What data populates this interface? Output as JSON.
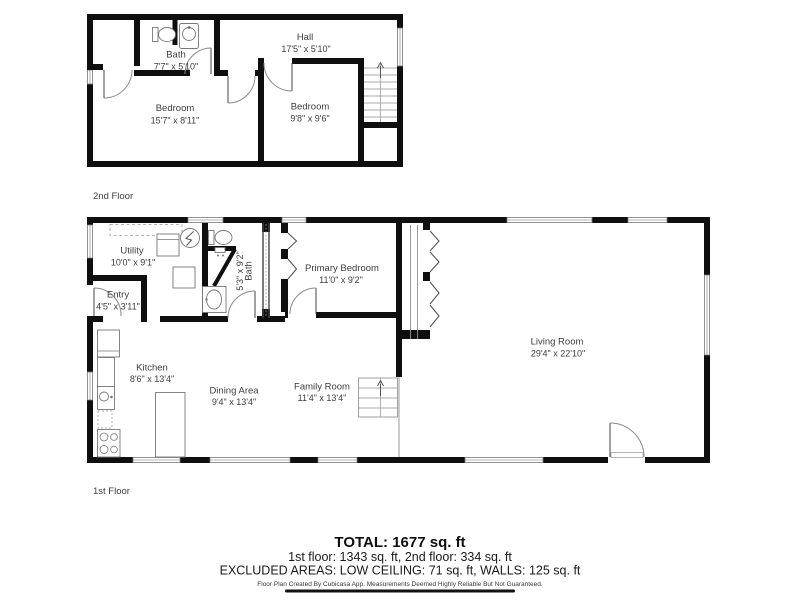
{
  "page": {
    "background": "#ffffff"
  },
  "colors": {
    "wall": "#0f0f0f",
    "label_text": "#3d3d3d",
    "thin_line": "#8f8f8f"
  },
  "floors": {
    "second": {
      "label": "2nd Floor",
      "rooms": {
        "bath": {
          "name": "Bath",
          "dims": "7'7\" x 5'10\""
        },
        "hall": {
          "name": "Hall",
          "dims": "17'5\" x 5'10\""
        },
        "bedroom_left": {
          "name": "Bedroom",
          "dims": "15'7\" x 8'11\""
        },
        "bedroom_right": {
          "name": "Bedroom",
          "dims": "9'8\" x 9'6\""
        }
      }
    },
    "first": {
      "label": "1st Floor",
      "rooms": {
        "utility": {
          "name": "Utility",
          "dims": "10'0\" x 9'1\""
        },
        "entry": {
          "name": "Entry",
          "dims": "4'5\" x 3'11\""
        },
        "bath": {
          "name": "Bath",
          "dims": "5'3\" x 9'2\""
        },
        "primary_bedroom": {
          "name": "Primary Bedroom",
          "dims": "11'0\" x 9'2\""
        },
        "kitchen": {
          "name": "Kitchen",
          "dims": "8'6\" x 13'4\""
        },
        "dining_area": {
          "name": "Dining Area",
          "dims": "9'4\" x 13'4\""
        },
        "family_room": {
          "name": "Family Room",
          "dims": "11'4\" x 13'4\""
        },
        "living_room": {
          "name": "Living Room",
          "dims": "29'4\" x 22'10\""
        }
      }
    }
  },
  "summary": {
    "total": "TOTAL: 1677 sq. ft",
    "floor_breakdown": "1st floor: 1343 sq. ft, 2nd floor: 334 sq. ft",
    "excluded_areas": "EXCLUDED AREAS: LOW CEILING: 71 sq. ft, WALLS: 125 sq. ft",
    "disclaimer": "Floor Plan Created By Cubicasa App. Measurements Deemed Highly Reliable But Not Guaranteed."
  }
}
